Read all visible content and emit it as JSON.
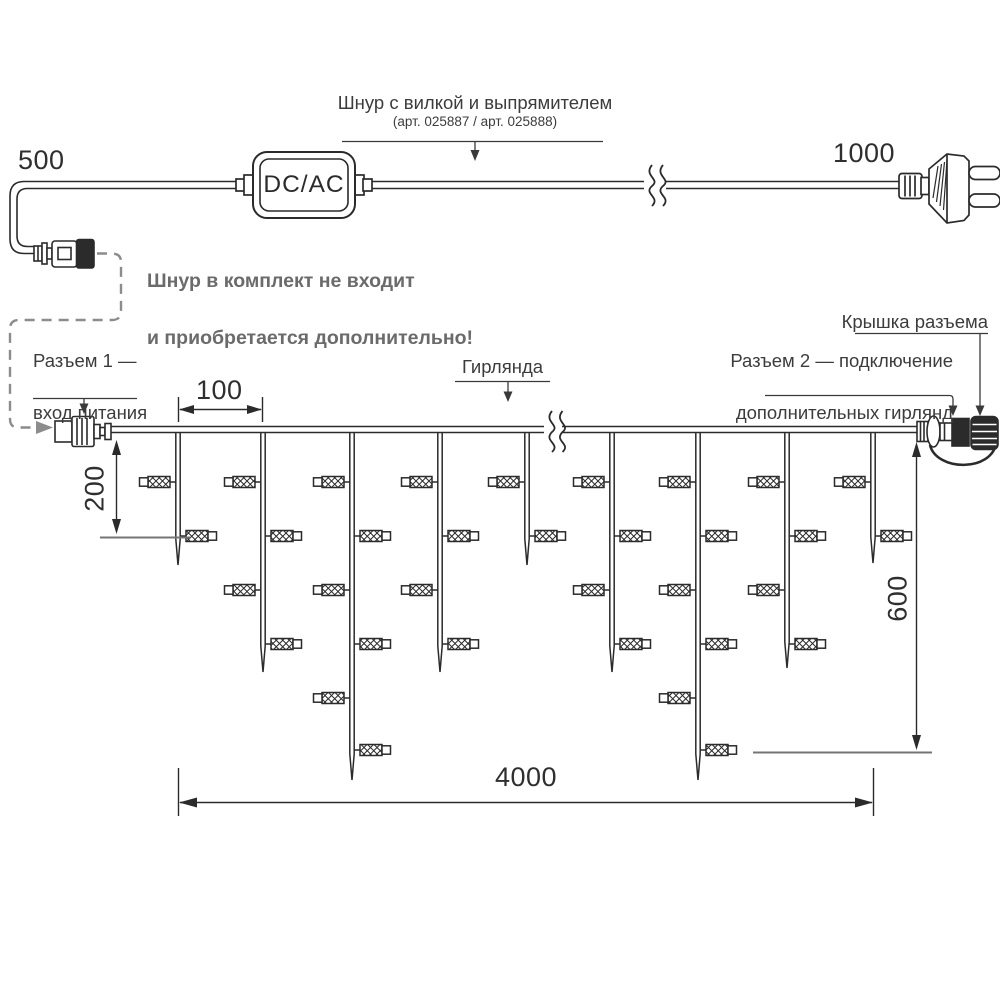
{
  "colors": {
    "line": "#2b2b2b",
    "label": "#3c3c3c",
    "dim_text": "#2f2f2f",
    "muted_note": "#6b6b6b",
    "dashed_gray": "#8c8c8c",
    "ref_line": "#757575",
    "background": "#ffffff"
  },
  "adapter": {
    "label": "DC/AC"
  },
  "cord_note": {
    "title": "Шнур с вилкой и выпрямителем",
    "subtitle": "(арт. 025887 / арт. 025888)"
  },
  "not_included_note": {
    "line1": "Шнур в комплект не входит",
    "line2": "и приобретается дополнительно!"
  },
  "connector1_label": {
    "line1": "Разъем 1 —",
    "line2": "вход питания"
  },
  "garland_label": "Гирлянда",
  "cap_label": "Крышка разъема",
  "connector2_label": {
    "line1": "Разъем 2 — подключение",
    "line2": "дополнительных гирлянд"
  },
  "dimensions": {
    "cord_left": "500",
    "cord_right": "1000",
    "drop_spacing": "100",
    "short_drop": "200",
    "long_drop": "600",
    "total_width": "4000"
  },
  "garland": {
    "wire_bottom_y": 433,
    "drop_half_width": 2.2,
    "taper": 26,
    "bulb_row_y": [
      482,
      536,
      590,
      644,
      698,
      750
    ],
    "drops": [
      {
        "x": 178,
        "bulb_count": 2,
        "tip_y": 565
      },
      {
        "x": 263,
        "bulb_count": 4,
        "tip_y": 672
      },
      {
        "x": 352,
        "bulb_count": 6,
        "tip_y": 780
      },
      {
        "x": 440,
        "bulb_count": 4,
        "tip_y": 672
      },
      {
        "x": 527,
        "bulb_count": 2,
        "tip_y": 565
      },
      {
        "x": 612,
        "bulb_count": 4,
        "tip_y": 672
      },
      {
        "x": 698,
        "bulb_count": 6,
        "tip_y": 780
      },
      {
        "x": 787,
        "bulb_count": 4,
        "tip_y": 668
      },
      {
        "x": 873,
        "bulb_count": 2,
        "tip_y": 563
      }
    ]
  }
}
